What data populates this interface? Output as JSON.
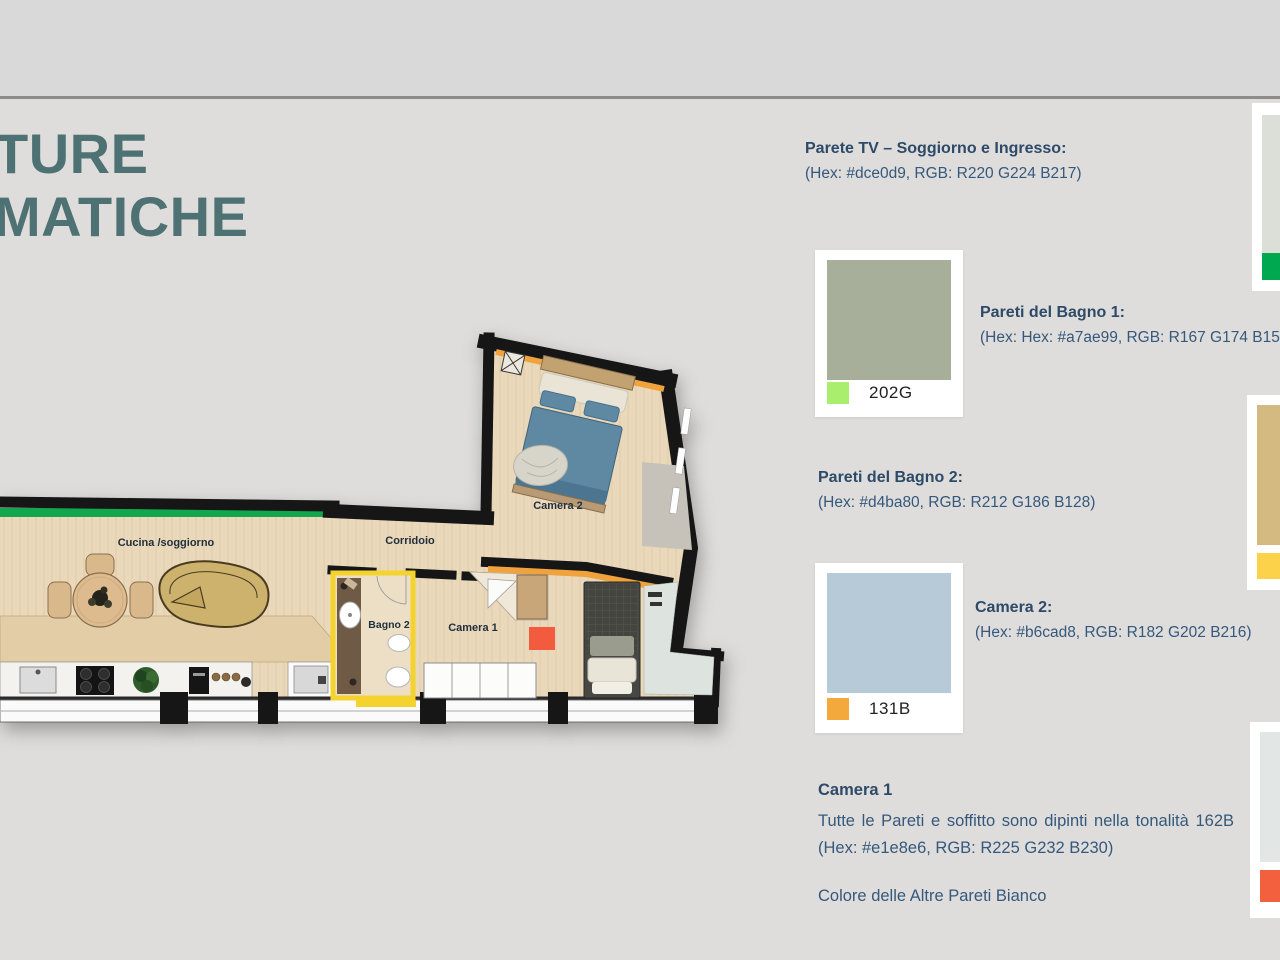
{
  "slide": {
    "title_lines": [
      "TURE",
      "MATICHE"
    ],
    "theme": {
      "title_color": "#4e7173",
      "heading_color": "#2d4a68",
      "body_color": "#35587c",
      "background": "#dedddb",
      "band_background": "#d9d9d9",
      "divider_color": "#8c8c8c"
    }
  },
  "floor_plan": {
    "rooms": [
      {
        "label": "Cucina /soggiorno"
      },
      {
        "label": "Corridoio"
      },
      {
        "label": "Bagno 2"
      },
      {
        "label": "Camera 1"
      },
      {
        "label": "Camera 2"
      }
    ],
    "accents": {
      "green_wall": "#12a64f",
      "orange_wall": "#f0a23c",
      "bagno2_outline": "#f4d32e",
      "camera1_marker": "#f25b3d",
      "bed_blue": "#5f89a2"
    }
  },
  "notes": [
    {
      "heading": "Parete TV – Soggiorno e Ingresso:",
      "detail": "(Hex: #dce0d9, RGB: R220 G224 B217)"
    },
    {
      "heading": "Pareti del Bagno 1:",
      "detail": "(Hex: Hex: #a7ae99, RGB: R167 G174 B153)"
    },
    {
      "heading": "Pareti del Bagno 2:",
      "detail": "(Hex: #d4ba80, RGB: R212 G186 B128)"
    },
    {
      "heading": "Camera 2:",
      "detail": "(Hex: #b6cad8, RGB: R182 G202 B216)"
    }
  ],
  "camera1_note": {
    "heading": "Camera 1",
    "body": "Tutte le Pareti e soffitto sono dipinti nella tonalità 162B (Hex: #e1e8e6, RGB: R225 G232 B230)",
    "footer": "Colore delle Altre Pareti Bianco"
  },
  "cards": [
    {
      "code": "202G",
      "swatch": "#a7ae99",
      "chip": "#a9ee6d"
    },
    {
      "code": "131B",
      "swatch": "#b6cad8",
      "chip": "#f4a93c"
    }
  ],
  "partial_cards": [
    {
      "swatch": "#dcdfd8",
      "chip": "#00a94f"
    },
    {
      "swatch": "#d4ba80",
      "chip": "#fcd24b"
    },
    {
      "swatch": "#e2e6e4",
      "chip": "#f2603d"
    }
  ]
}
